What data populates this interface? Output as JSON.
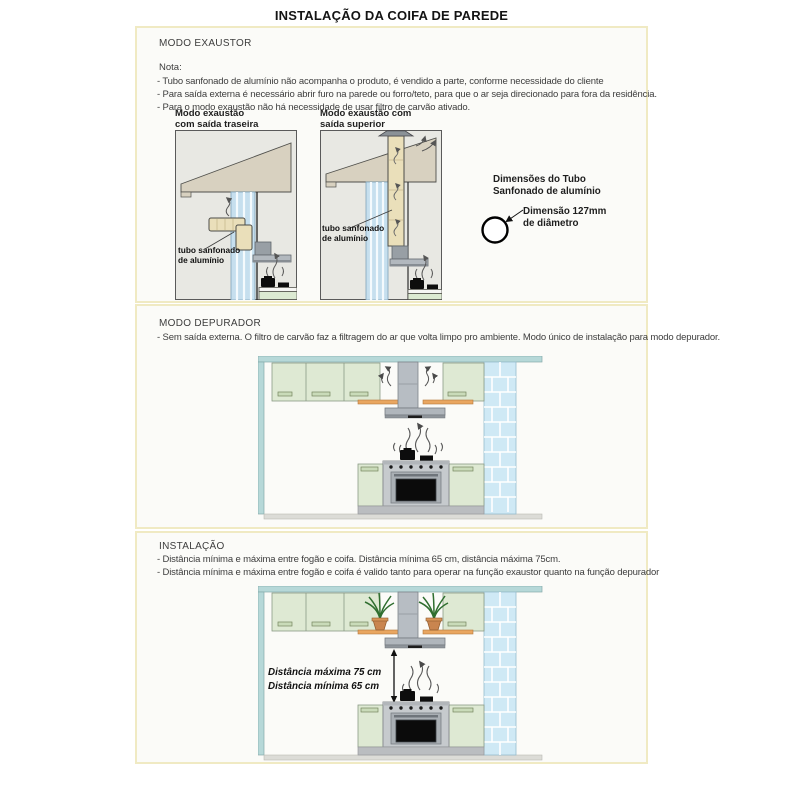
{
  "page": {
    "title": "INSTALAÇÃO DA COIFA DE PAREDE"
  },
  "colors": {
    "section_border": "#f0eac3",
    "section_bg": "#fbfbf8",
    "diagram_bg": "#e8e8e3",
    "roof_beige": "#d8d1c0",
    "pipe_beige": "#eadfba",
    "duct_blue": "#c6dfee",
    "kitchen_teal": "#b6d8d8",
    "brick_blue": "#cfe9f5",
    "cabinet_green": "#dee9d3",
    "hood_gray": "#b2b8be",
    "shelf_orange": "#e9a660"
  },
  "exaustor": {
    "heading": "MODO EXAUSTOR",
    "nota_label": "Nota:",
    "bullets": [
      "- Tubo sanfonado de alumínio não acompanha o produto, é vendido a parte, conforme necessidade do cliente",
      "- Para saída externa é necessário abrir furo na parede ou forro/teto, para que o ar seja direcionado para fora da residência.",
      "- Para o modo exaustão não há necessidade de usar filtro de carvão ativado."
    ],
    "pipe_label": {
      "line1": "tubo sanfonado",
      "line2": "de alumínio"
    },
    "diagram_rear": {
      "caption_line1": "Modo exaustão",
      "caption_line2": "com saída traseira"
    },
    "diagram_top": {
      "caption_line1": "Modo exaustão com",
      "caption_line2": "saída superior"
    },
    "tube_dimensions": {
      "title_line1": "Dimensões do Tubo",
      "title_line2": "Sanfonado de alumínio",
      "diameter_line1": "Dimensão 127mm",
      "diameter_line2": "de diâmetro"
    }
  },
  "depurador": {
    "heading": "MODO DEPURADOR",
    "bullets": [
      "- Sem saída externa. O filtro de carvão faz a filtragem do ar que volta limpo pro ambiente. Modo único de instalação para modo depurador."
    ]
  },
  "instalacao": {
    "heading": "INSTALAÇÃO",
    "bullets": [
      "- Distância mínima e máxima entre fogão e coifa. Distância mínima 65 cm, distância máxima 75cm.",
      "- Distância mínima e máxima entre fogão e coifa é valido tanto para operar na função exaustor quanto na função depurador"
    ],
    "distance_max_label": "Distância máxima 75 cm",
    "distance_min_label": "Distância mínima 65 cm"
  }
}
